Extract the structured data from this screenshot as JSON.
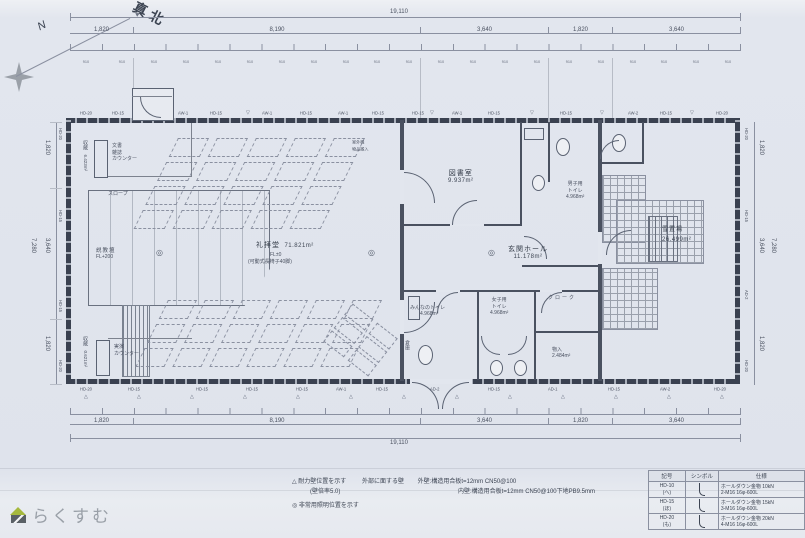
{
  "compass": {
    "true_north": "真北",
    "north": "N"
  },
  "dims": {
    "total": "19,110",
    "seg1": "1,820",
    "seg2": "8,190",
    "seg3": "3,640",
    "seg4": "1,820",
    "seg5": "3,640",
    "module": "910",
    "side_total": "7,280",
    "sseg1": "1,820",
    "sseg2": "3,640",
    "sseg3": "1,820"
  },
  "rooms": {
    "hall": {
      "name": "礼拝堂",
      "area": "71.821m²",
      "level": "FL±0",
      "note": "(可動式長椅子40脚)"
    },
    "library": {
      "name": "図書室",
      "area": "9.937m²"
    },
    "entrance_hall": {
      "name": "玄関ホール",
      "area": "11.178m²"
    },
    "mens_toilet": {
      "name": "男子用",
      "name2": "トイレ",
      "area": "4.968m²"
    },
    "womens_toilet": {
      "name": "女子用",
      "name2": "トイレ",
      "area": "4.968m²"
    },
    "everyones_toilet": {
      "name": "みんなのトイレ",
      "area": "4.968m²"
    },
    "cloak": {
      "name": "クローク"
    },
    "storage_small": {
      "name": "物入",
      "area": "2.484m²"
    },
    "warehouse": {
      "name": "倉庫"
    },
    "snow_yard": {
      "name": "雪置場",
      "area": "26.499m²"
    },
    "pulpit": {
      "name": "説教壇",
      "level": "FL+200"
    },
    "ramp": {
      "name": "スロープ"
    },
    "doc_counter": {
      "l1": "文書",
      "l2": "雑誌",
      "l3": "カウンター"
    },
    "demo_counter": {
      "l1": "実演",
      "l2": "カウンター"
    },
    "archive_top": {
      "name": "収蔵",
      "area": "6.423m²"
    },
    "archive_bottom": {
      "name": "収蔵",
      "area": "0.621m²"
    }
  },
  "wall_codes": {
    "hd10": "HD-10",
    "hd15": "HD-15",
    "hd20": "HD-20",
    "aw1": "AW-1",
    "aw2": "AW-2",
    "ad1": "AD-1",
    "ad2": "AD-2"
  },
  "symbols": {
    "triangle": "△",
    "tri_down": "▽",
    "circle": "◎"
  },
  "annotations": {
    "outdoor_unit": "室外機",
    "carry_in": "物品搬入"
  },
  "notes": {
    "shear_wall": "△ 耐力壁位置を示す",
    "wall_ratio": "(壁倍率5.0)",
    "ext_facing": "外部に面する壁",
    "ext_spec": "外壁:構造用合板t=12mm CN50@100",
    "int_spec": "内壁:構造用合板t=12mm CN50@100下地PB9.5mm",
    "em_light": "◎ 非常用照明位置を示す"
  },
  "legend": {
    "headers": {
      "h1": "記号",
      "h2": "シンボル",
      "h3": "仕様"
    },
    "rows": [
      {
        "code": "HD-10",
        "kana": "(へ)",
        "spec": "ホールダウン金物 10kN",
        "bolt": "2-M16 16φ-600L"
      },
      {
        "code": "HD-15",
        "kana": "(ほ)",
        "spec": "ホールダウン金物 15kN",
        "bolt": "3-M16 16φ-600L"
      },
      {
        "code": "HD-20",
        "kana": "(も)",
        "spec": "ホールダウン金物 20kN",
        "bolt": "4-M16 16φ-600L"
      }
    ]
  },
  "logo": {
    "text": "らくすむ"
  }
}
